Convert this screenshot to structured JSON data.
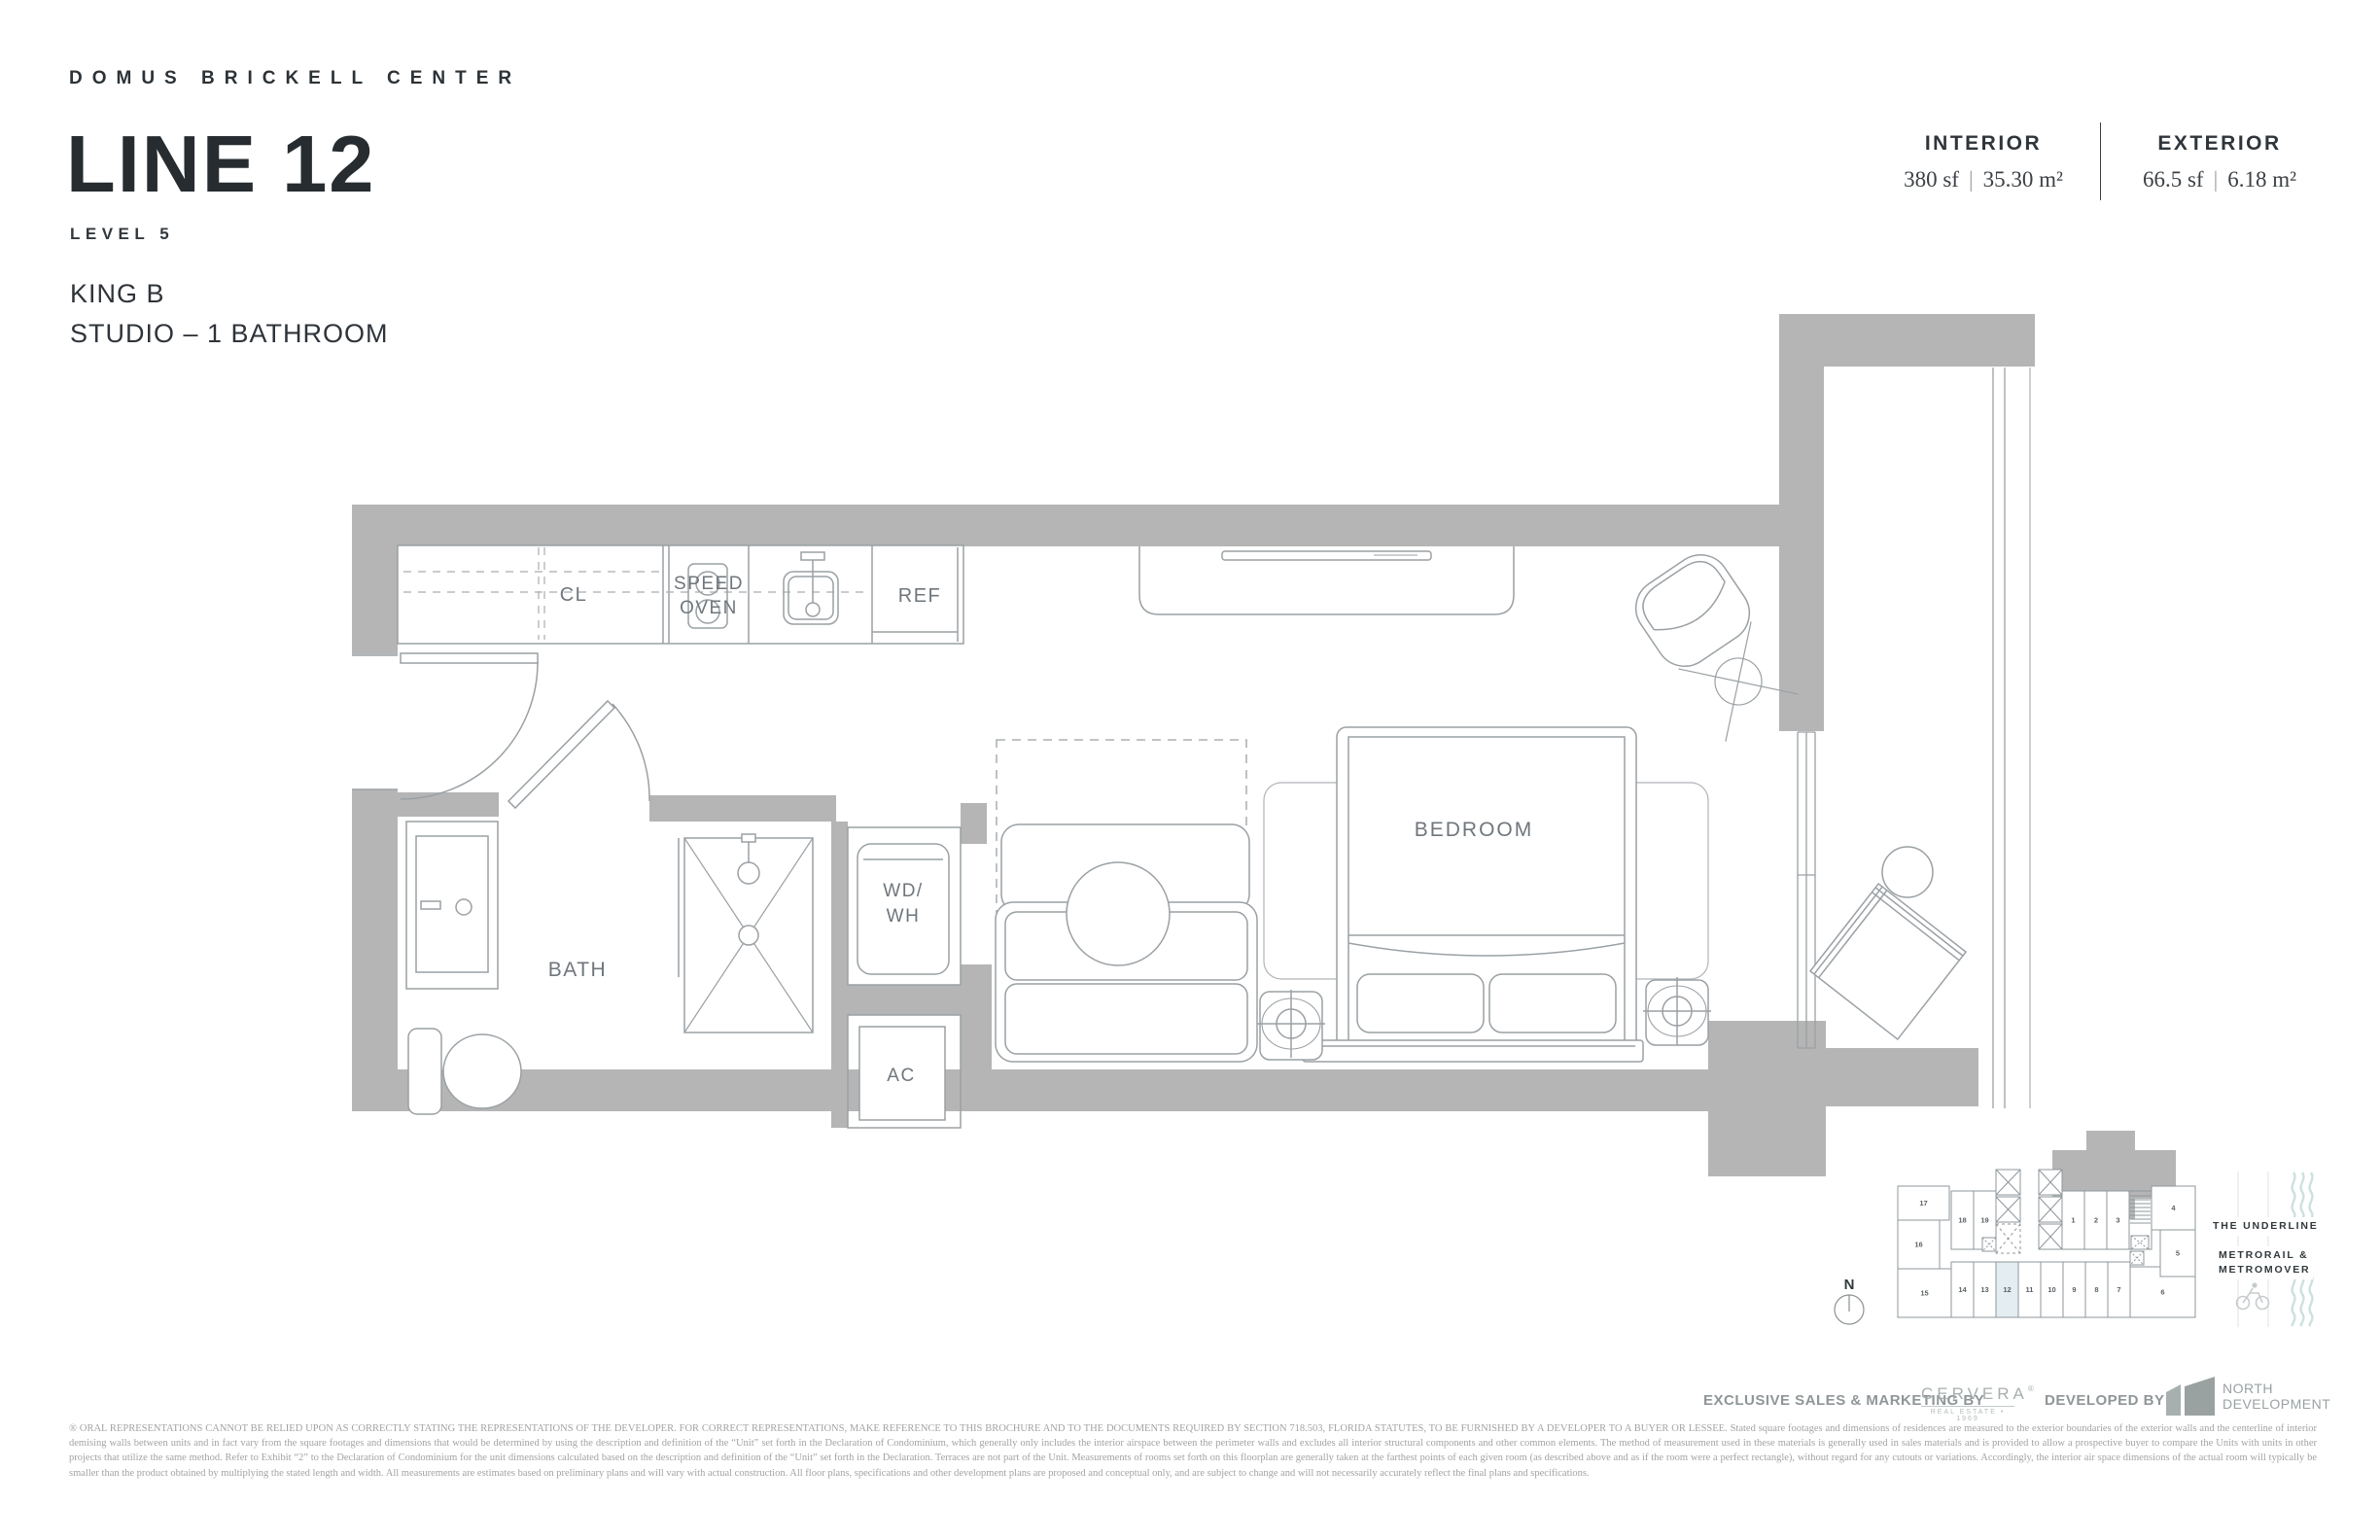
{
  "header": {
    "project_name": "DOMUS BRICKELL CENTER",
    "line_title": "LINE 12",
    "level": "LEVEL 5",
    "unit_type": "KING B",
    "unit_config": "STUDIO – 1 BATHROOM",
    "stats": {
      "interior": {
        "label": "INTERIOR",
        "sf": "380 sf",
        "m2": "35.30 m²"
      },
      "exterior": {
        "label": "EXTERIOR",
        "sf": "66.5 sf",
        "m2": "6.18 m²"
      }
    }
  },
  "floorplan": {
    "labels": {
      "closet": "CL",
      "speed_oven_1": "SPEED",
      "speed_oven_2": "OVEN",
      "fridge": "REF",
      "bath": "BATH",
      "washer_dryer_1": "WD/",
      "washer_dryer_2": "WH",
      "ac": "AC",
      "bedroom": "BEDROOM"
    },
    "colors": {
      "wall": "#b5b5b5",
      "line": "#9aa0a4",
      "label": "#6f767c"
    }
  },
  "keyplan": {
    "compass_label": "N",
    "highlighted_unit": "12",
    "highlight_color": "#e3edf2",
    "units": [
      "17",
      "16",
      "18",
      "19",
      "15",
      "14",
      "13",
      "12",
      "11",
      "10",
      "9",
      "8",
      "7",
      "6",
      "1",
      "2",
      "3",
      "4",
      "5"
    ],
    "annotations": {
      "underline": "THE UNDERLINE",
      "metro_1": "METRORAIL &",
      "metro_2": "METROMOVER"
    }
  },
  "footer": {
    "sales_by": "EXCLUSIVE SALES & MARKETING BY",
    "cervera_name": "CERVERA",
    "cervera_reg": "®",
    "cervera_sub": "REAL ESTATE • 1969",
    "developed_by": "DEVELOPED BY",
    "developer_name_1": "NORTH",
    "developer_name_2": "DEVELOPMENT",
    "disclaimer": "® ORAL REPRESENTATIONS CANNOT BE RELIED UPON AS CORRECTLY STATING THE REPRESENTATIONS OF THE DEVELOPER. FOR CORRECT REPRESENTATIONS, MAKE REFERENCE TO THIS BROCHURE AND TO THE DOCUMENTS REQUIRED BY SECTION 718.503, FLORIDA STATUTES, TO BE FURNISHED BY A DEVELOPER TO A BUYER OR LESSEE. Stated square footages and dimensions of residences are measured to the exterior boundaries of the exterior walls and the centerline of interior demising walls between units and in fact vary from the square footages and dimensions that would be determined by using the description and definition of the “Unit” set forth in the Declaration of Condominium, which generally only includes the interior airspace between the perimeter walls and excludes all interior structural components and other common elements.  The method of measurement used in these materials is generally used in sales materials and is provided to allow a prospective buyer to compare the Units with units in other projects that utilize the same method. Refer to Exhibit “2” to the Declaration of Condominium for the unit dimensions calculated based on the description and definition of the “Unit” set forth in the Declaration. Terraces are not part of the Unit.  Measurements of rooms set forth on this floorplan are generally taken at the farthest points of each given room (as described above and as if the room were a perfect rectangle), without regard for any cutouts or variations.  Accordingly, the interior air space dimensions of the actual room will typically be smaller than the product obtained by multiplying the stated length and width.  All measurements are estimates based on preliminary plans and will vary with actual construction. All floor plans, specifications and other development plans are proposed and conceptual only, and are subject to change and will not necessarily accurately reflect the final plans and specifications."
  }
}
